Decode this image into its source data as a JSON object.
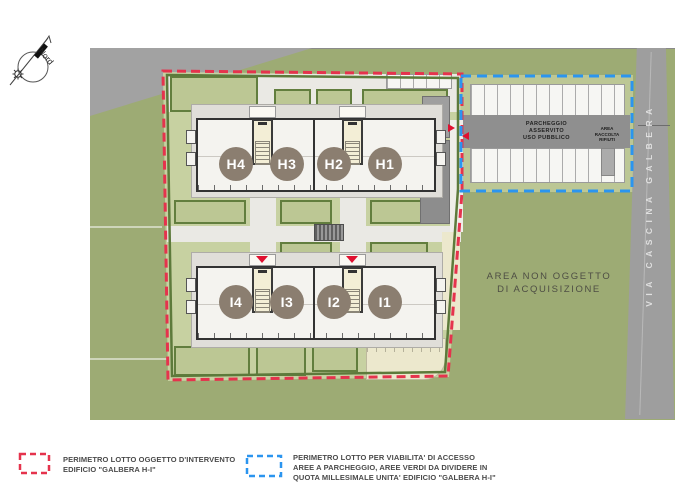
{
  "compass": {
    "north_label": "Nord"
  },
  "map": {
    "road_label": "VIA CASCINA GALBERA",
    "area_label": [
      "AREA NON OGGETTO",
      "DI ACQUISIZIONE"
    ],
    "parking": {
      "aisle_label": [
        "PARCHEGGIO",
        "ASSERVITO",
        "USO PUBBLICO"
      ],
      "waste_label": [
        "AREA",
        "RACCOLTA",
        "RIFIUTI"
      ]
    },
    "buildings": [
      {
        "name": "building-h",
        "units": [
          "H4",
          "H3",
          "H2",
          "H1"
        ]
      },
      {
        "name": "building-i",
        "units": [
          "I4",
          "I3",
          "I2",
          "I1"
        ]
      }
    ]
  },
  "legend": [
    {
      "color": "#e5334d",
      "lines": [
        "PERIMETRO LOTTO OGGETTO D'INTERVENTO",
        "EDIFICIO \"GALBERA H-I\""
      ]
    },
    {
      "color": "#2b95ef",
      "lines": [
        "PERIMETRO LOTTO PER VIABILITA' DI ACCESSO",
        "AREE A PARCHEGGIO, AREE VERDI DA DIVIDERE IN",
        "QUOTA MILLESIMALE UNITA' EDIFICIO \"GALBERA H-I\""
      ]
    }
  ],
  "colors": {
    "lot_perimeter_red": "#e5334d",
    "access_perimeter_blue": "#2b95ef",
    "outer_green": "#9dab74",
    "inner_green": "#c7d1a1",
    "hedge_green": "#5e7b3a",
    "road_gray": "#9e9e9e",
    "unit_badge_brown": "#8b7e70"
  }
}
